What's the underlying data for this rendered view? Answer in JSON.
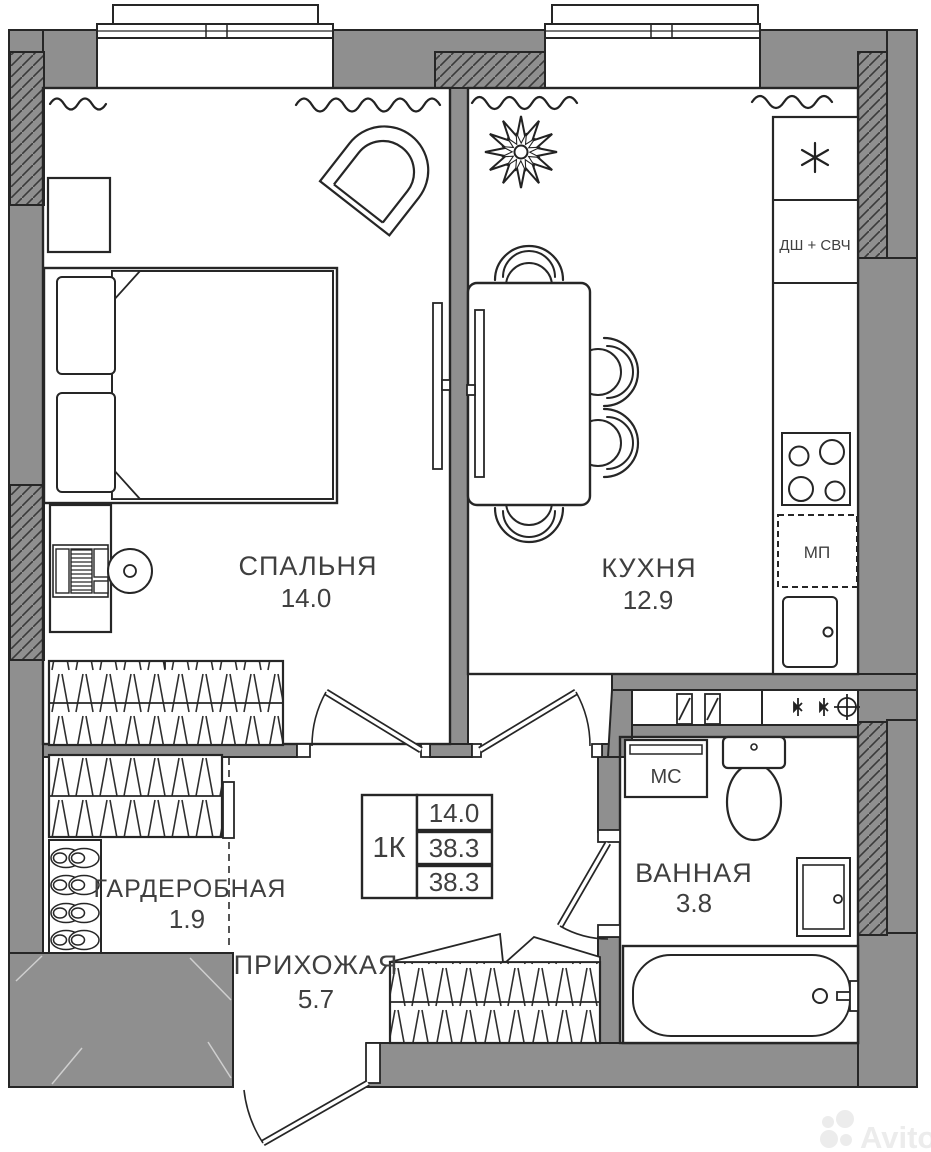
{
  "plan": {
    "rooms": [
      {
        "id": "bedroom",
        "name": "СПАЛЬНЯ",
        "area": "14.0"
      },
      {
        "id": "kitchen",
        "name": "КУХНЯ",
        "area": "12.9"
      },
      {
        "id": "bathroom",
        "name": "ВАННАЯ",
        "area": "3.8"
      },
      {
        "id": "wardrobe",
        "name": "ГАРДЕРОБНАЯ",
        "area": "1.9"
      },
      {
        "id": "hallway",
        "name": "ПРИХОЖАЯ",
        "area": "5.7"
      }
    ],
    "legend": {
      "type": "1К",
      "rows": [
        "14.0",
        "38.3",
        "38.3"
      ]
    },
    "appliances": {
      "dsh_svch": "ДШ + СВЧ",
      "mp": "МП",
      "ms": "МС"
    },
    "icons": {
      "fridge": "snowflake-asterisk",
      "plant": "flower-star",
      "logo": "avito-dots"
    },
    "watermark": "Avito",
    "colors": {
      "wall": "#8f8f8f",
      "line": "#262626",
      "text": "#3f3f3f",
      "watermark": "#ececec"
    }
  }
}
